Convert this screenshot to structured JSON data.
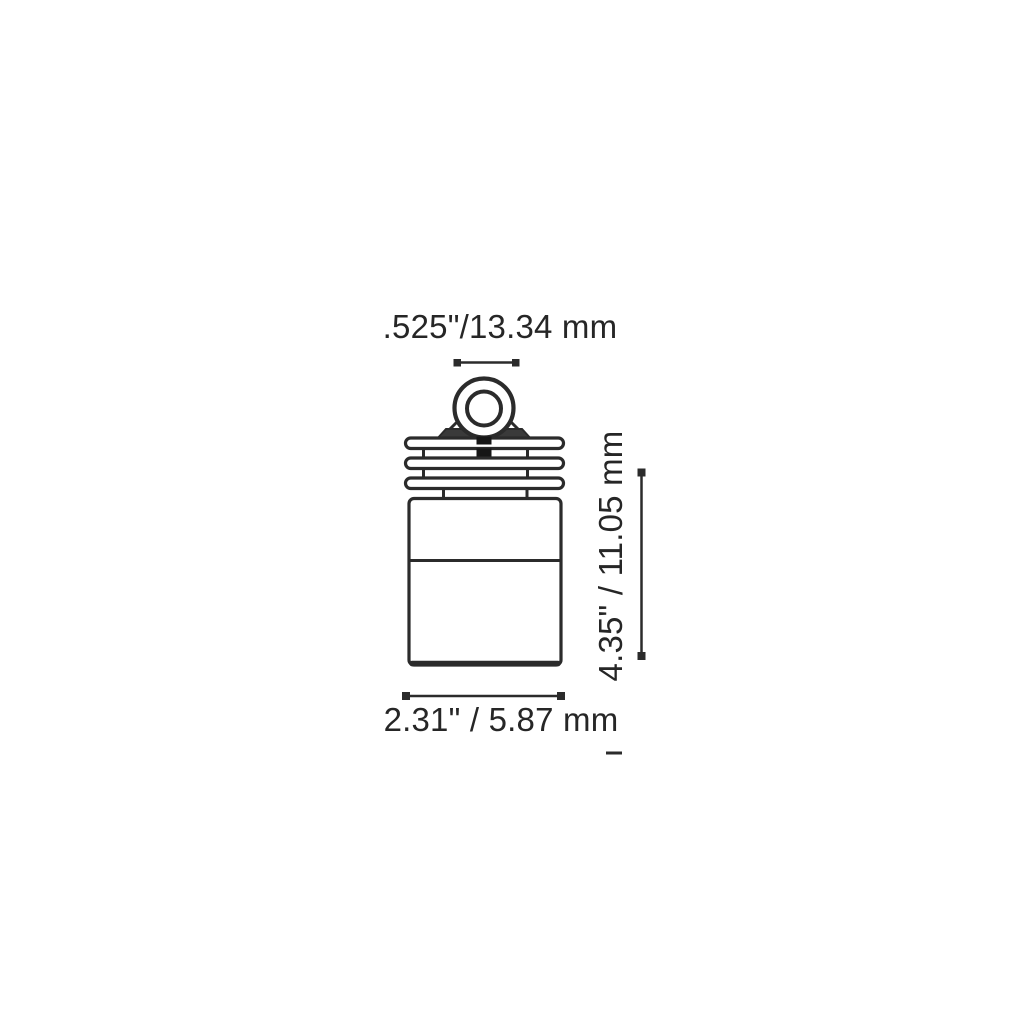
{
  "page": {
    "background": "#ffffff"
  },
  "colors": {
    "line": "#2b2b2b",
    "text": "#262626",
    "darkFill": "#3a3a3a",
    "notch": "#161616"
  },
  "diagram": {
    "type": "product-dimension-drawing",
    "figure": "cylindrical light fixture, front view: top eyelet loop, three heat-sink fins, cylindrical body",
    "labels": {
      "eyelet_width": ".525\"/13.34 mm",
      "height": "4.35\" / 11.05 mm",
      "body_width": "2.31\" / 5.87 mm"
    }
  }
}
